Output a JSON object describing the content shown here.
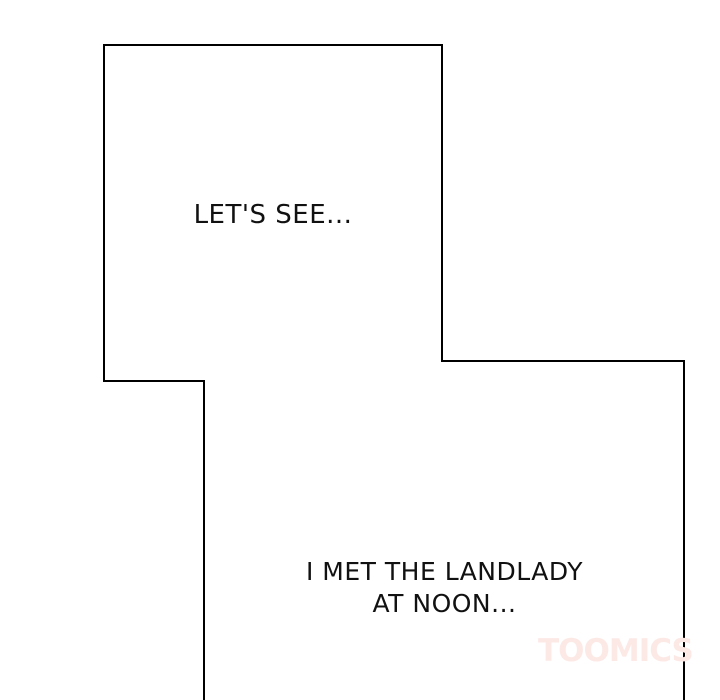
{
  "page": {
    "background_color": "#ffffff",
    "panel_fill_color": "#ffffff",
    "panel_border_color": "#000000"
  },
  "panels": {
    "top": {
      "dialogue": "LET'S SEE..."
    },
    "bottom": {
      "dialogue_lines": [
        "I MET THE LANDLADY",
        "AT NOON..."
      ]
    }
  },
  "watermark": {
    "text": "TOOMICS",
    "color": "#fce9e6"
  }
}
